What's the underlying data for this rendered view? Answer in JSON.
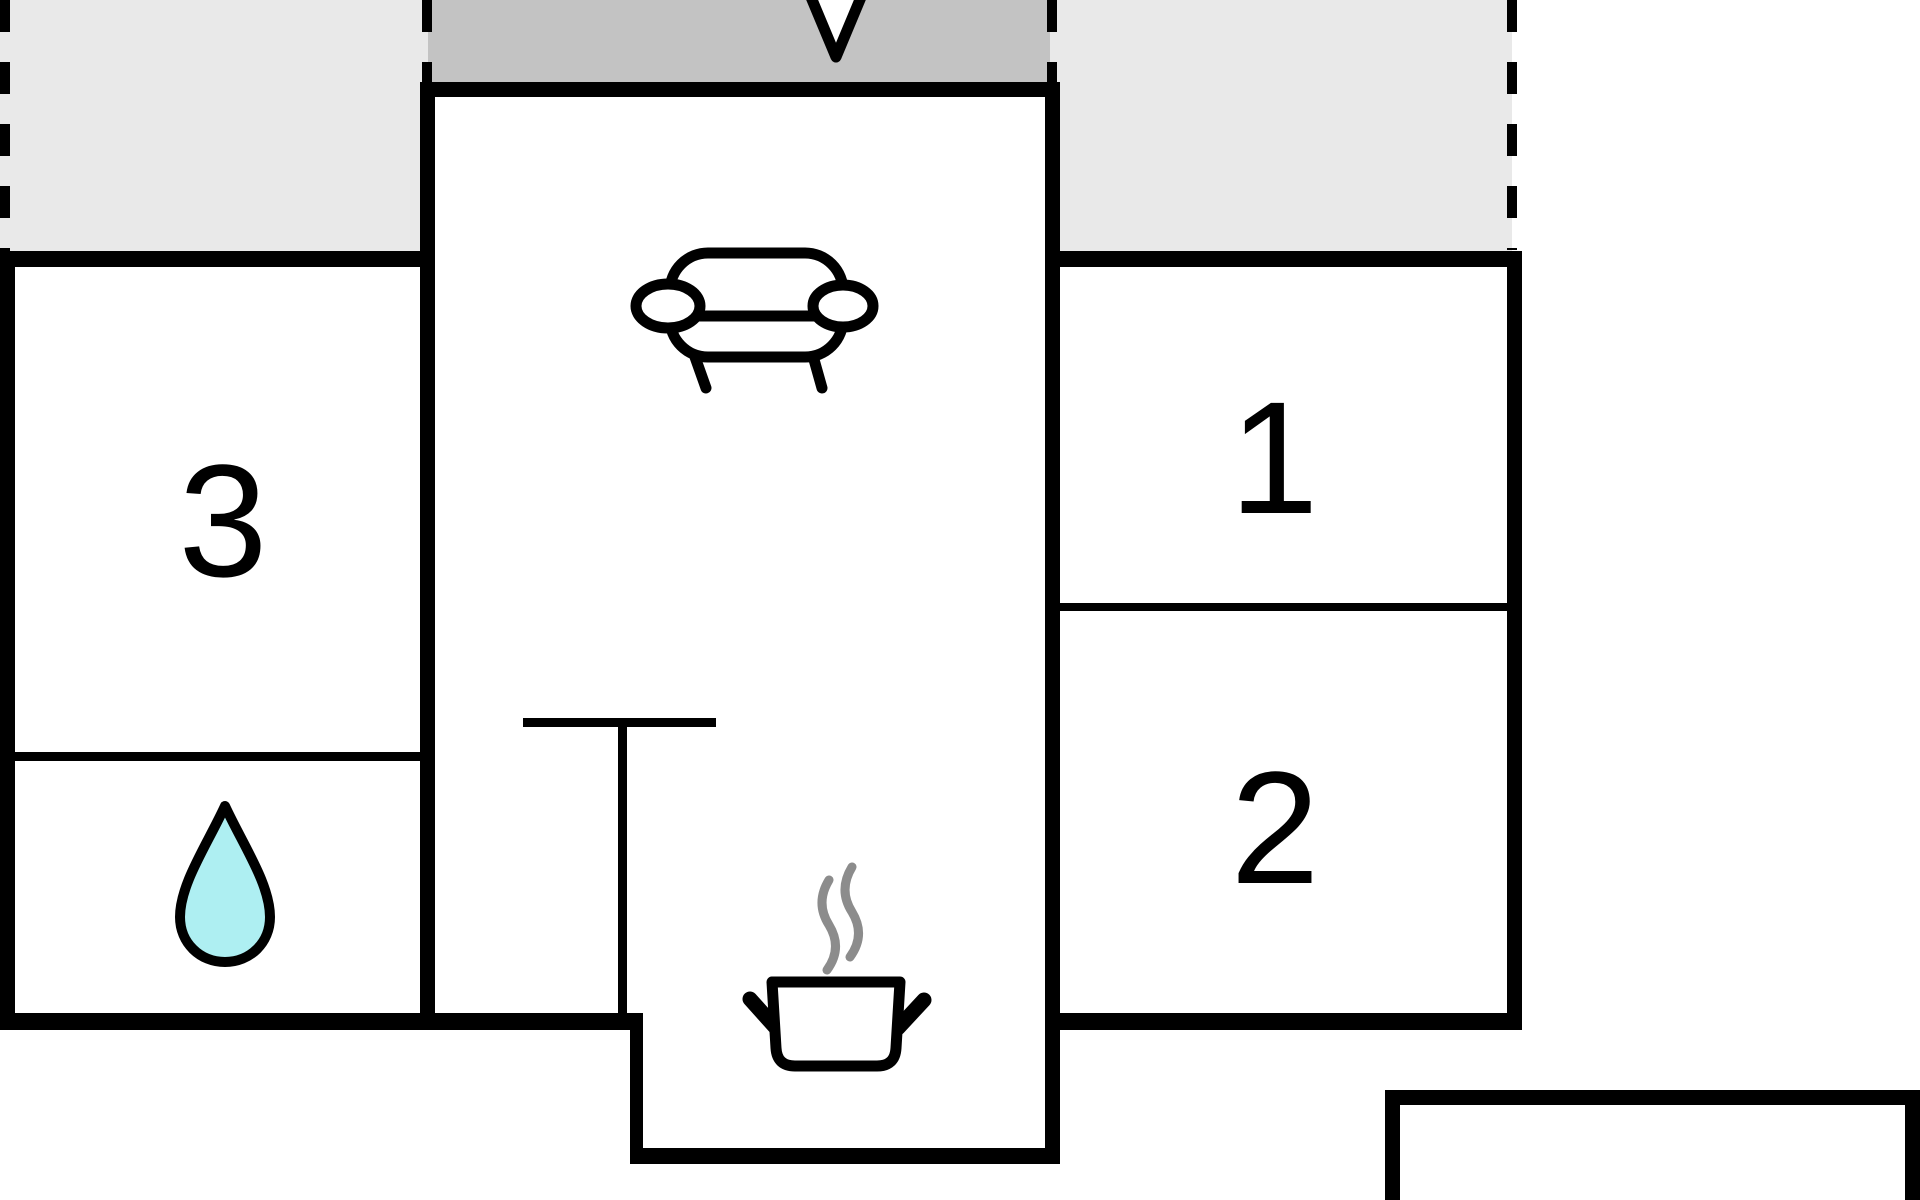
{
  "plan": {
    "type": "floor-plan",
    "rooms": [
      {
        "id": "room-1",
        "label": "1",
        "kind": "bedroom"
      },
      {
        "id": "room-2",
        "label": "2",
        "kind": "bedroom"
      },
      {
        "id": "room-3",
        "label": "3",
        "kind": "bedroom"
      },
      {
        "id": "bathroom",
        "label": "",
        "kind": "bathroom-with-water-drop"
      },
      {
        "id": "living-room",
        "label": "",
        "kind": "living-room-with-sofa"
      },
      {
        "id": "kitchen",
        "label": "",
        "kind": "kitchen-with-pot"
      }
    ]
  },
  "labels": {
    "room1": "1",
    "room2": "2",
    "room3": "3"
  },
  "icons": [
    "entrance-arrow-icon",
    "sofa-icon",
    "water-drop-icon",
    "cooking-pot-icon",
    "steam-icon"
  ],
  "colors": {
    "background": "#ffffff",
    "wall": "#000000",
    "terrace": "#e9e9e9",
    "porch": "#c3c3c3",
    "water_drop": "#aeeff2",
    "steam": "#8c8c8c",
    "arrow_fill": "#ffffff",
    "furniture_fill": "#ffffff"
  }
}
